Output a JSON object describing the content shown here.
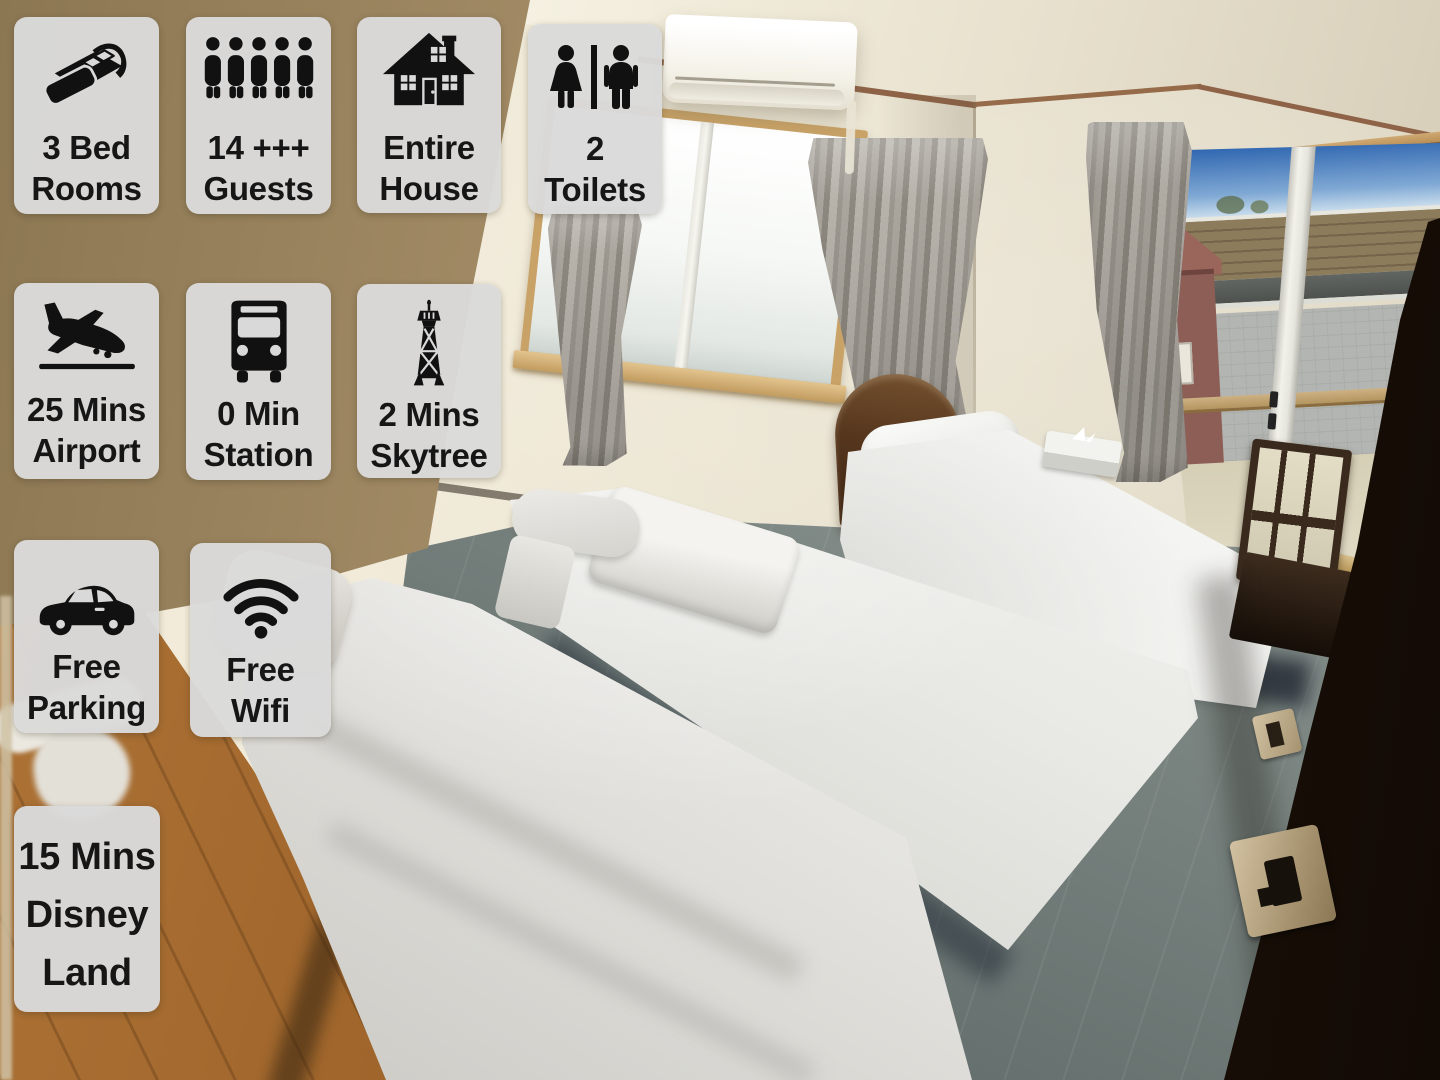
{
  "alt": "Photo of a rental bedroom with three single beds, two windows with grey curtains, a wall air conditioner, grey carpet, wooden hallway floor and a dark open door, overlaid with ten grey amenity badges",
  "palette": {
    "badge_bg": "#dadada",
    "badge_text": "#161616",
    "wall": "#efe8d6",
    "ceiling": "#f6f1e2",
    "trim": "#8f6347",
    "curtain": "#a09b93",
    "carpet": "#7f8985",
    "wood_floor": "#9c6229",
    "door": "#2a1507",
    "sky": "#2a62ae"
  },
  "badges": [
    {
      "id": "bedrooms",
      "icon": "bed-icon",
      "lines": [
        "3 Bed",
        "Rooms"
      ]
    },
    {
      "id": "guests",
      "icon": "guests-icon",
      "lines": [
        "14 +++",
        "Guests"
      ]
    },
    {
      "id": "entire-house",
      "icon": "house-icon",
      "lines": [
        "Entire",
        "House"
      ]
    },
    {
      "id": "toilets",
      "icon": "toilets-icon",
      "lines": [
        "2",
        "Toilets"
      ]
    },
    {
      "id": "airport",
      "icon": "airplane-landing-icon",
      "lines": [
        "25 Mins",
        "Airport"
      ]
    },
    {
      "id": "station",
      "icon": "bus-icon",
      "lines": [
        "0 Min",
        "Station"
      ]
    },
    {
      "id": "skytree",
      "icon": "skytree-tower-icon",
      "lines": [
        "2 Mins",
        "Skytree"
      ]
    },
    {
      "id": "free-parking",
      "icon": "car-icon",
      "lines": [
        "Free",
        "Parking"
      ]
    },
    {
      "id": "free-wifi",
      "icon": "wifi-icon",
      "lines": [
        "Free",
        "Wifi"
      ]
    },
    {
      "id": "disneyland",
      "icon": "none",
      "lines": [
        "15 Mins",
        "Disney",
        "Land"
      ]
    }
  ]
}
